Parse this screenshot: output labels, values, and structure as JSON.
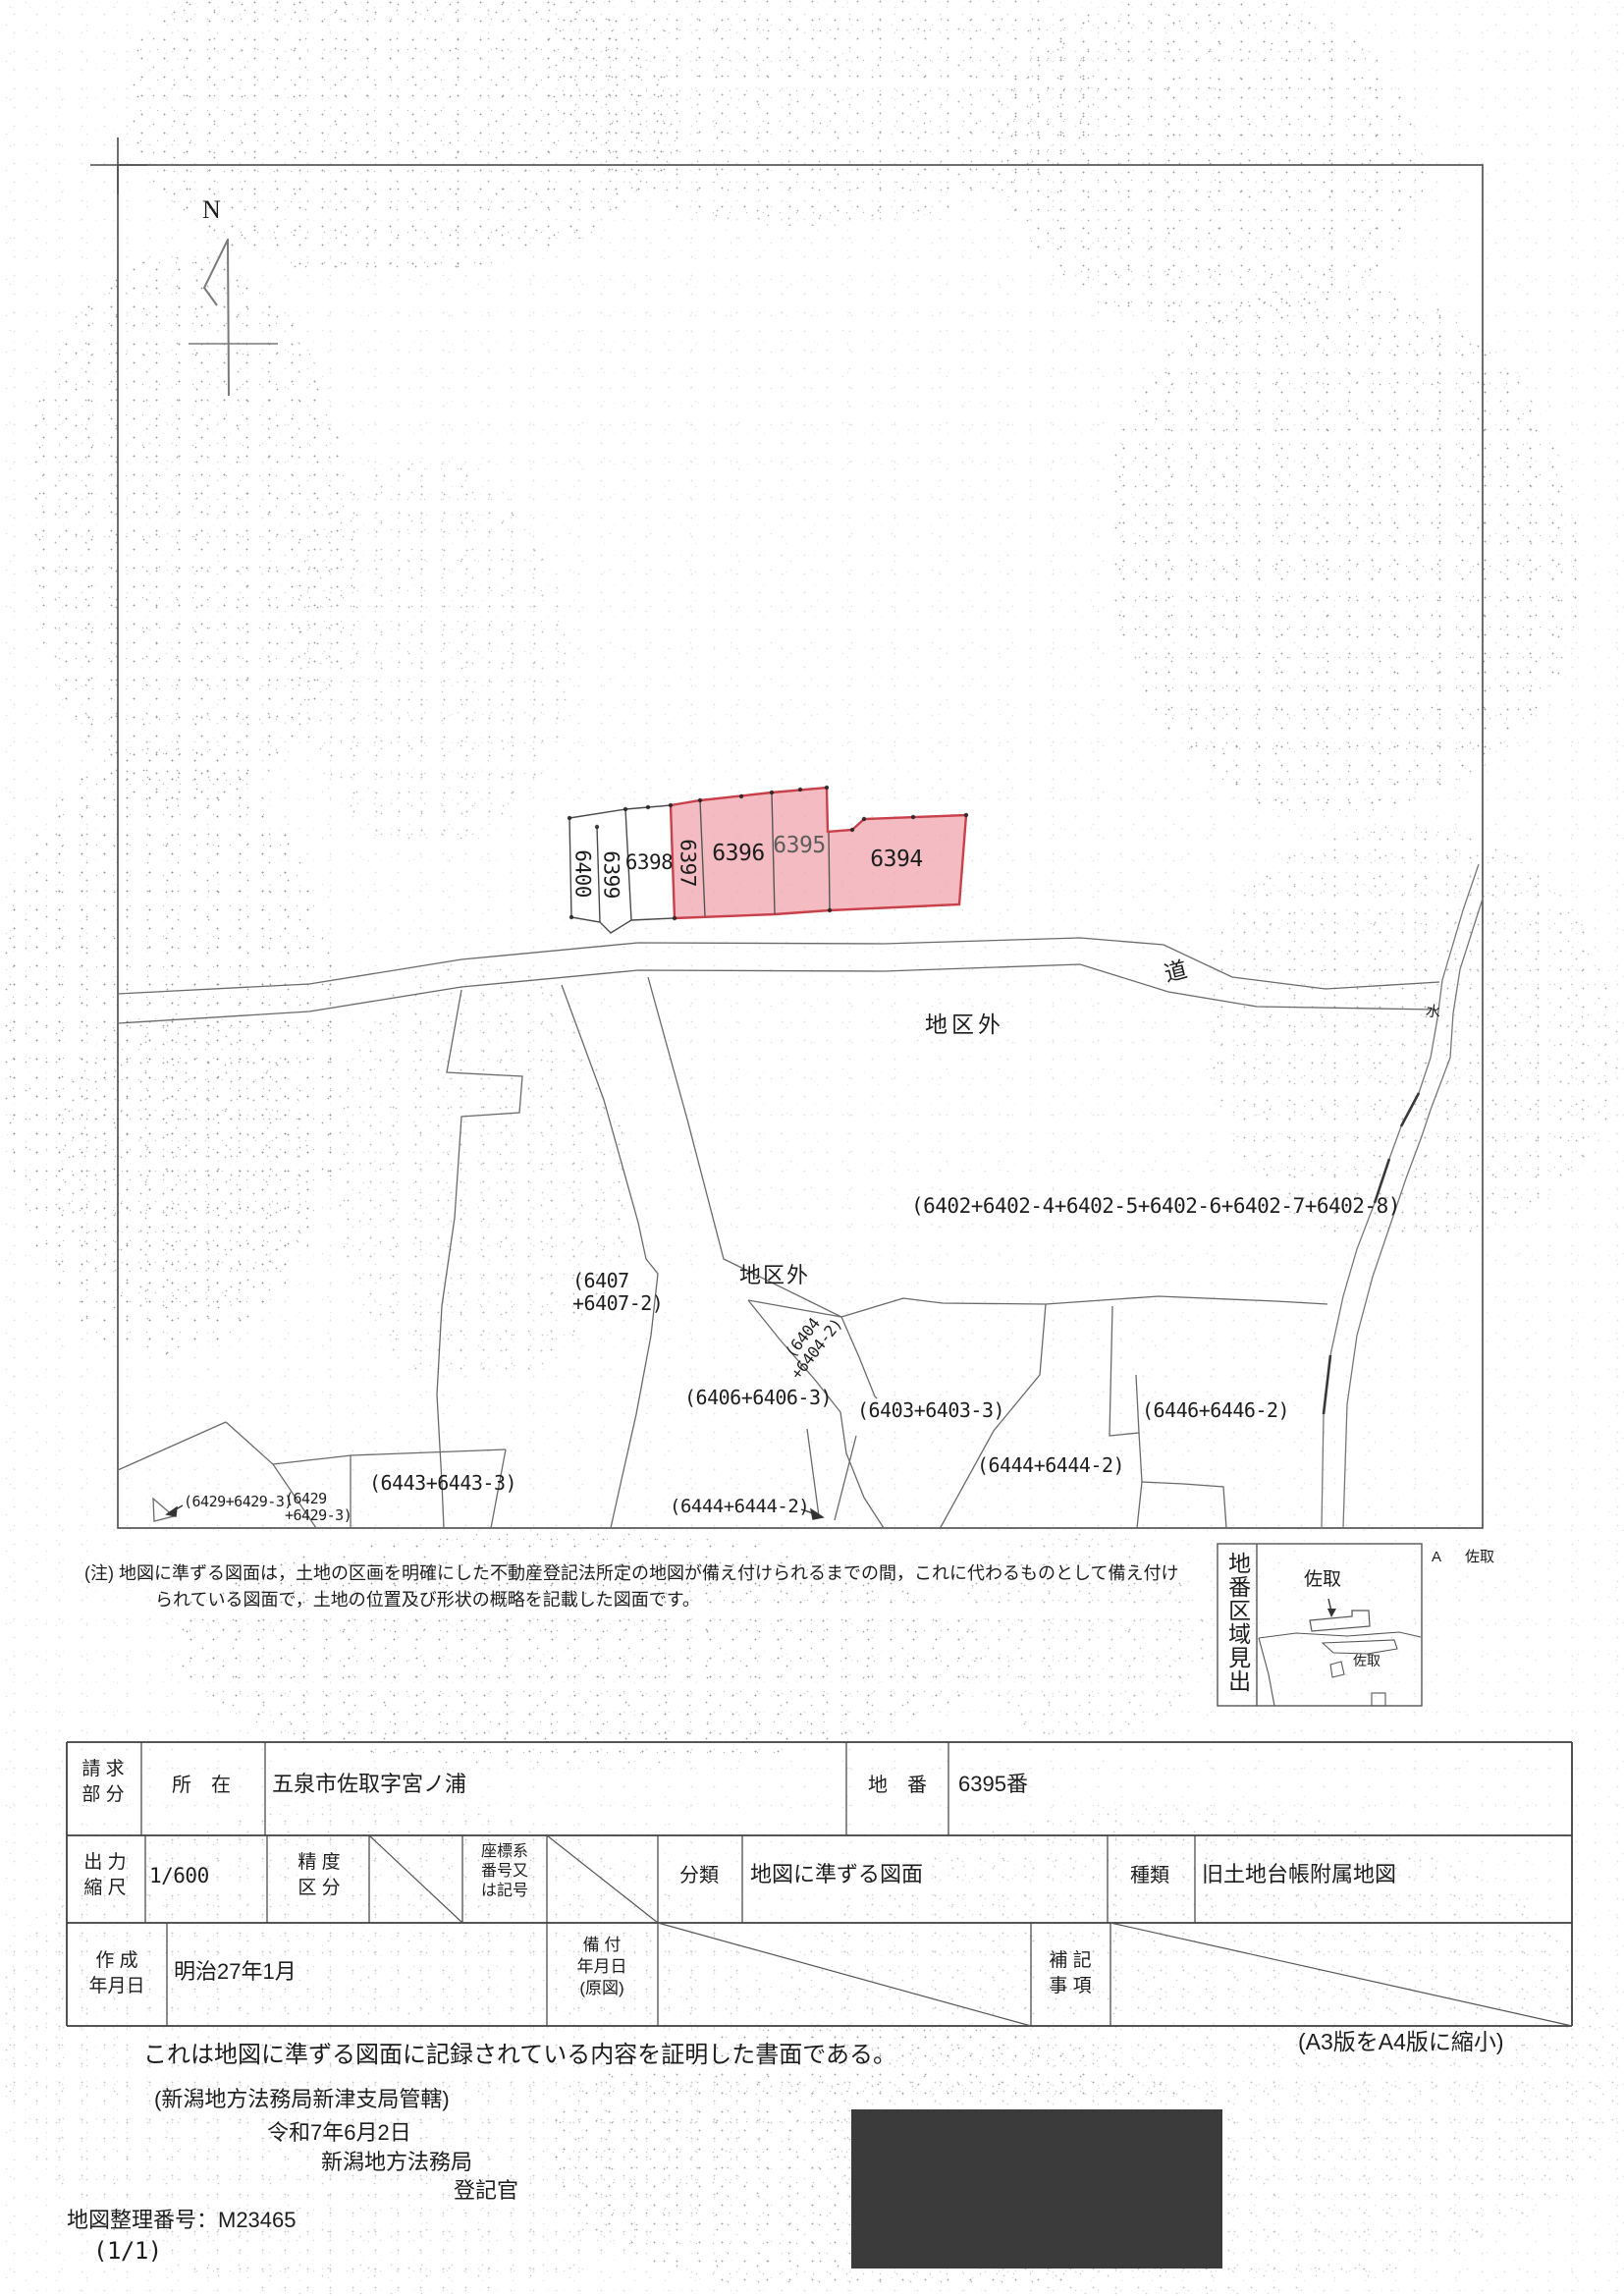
{
  "compass": {
    "label": "N"
  },
  "map": {
    "road_label": "道",
    "water_label": "水",
    "outside1": "地区外",
    "outside2": "地区外",
    "highlight_fill": "#f0a2aa",
    "highlight_stroke": "#c9404a",
    "parcels": {
      "p6400": "6400",
      "p6399": "6399",
      "p6398": "6398",
      "p6397": "6397",
      "p6396": "6396",
      "p6395": "6395",
      "p6394": "6394",
      "p6402": "(6402+6402-4+6402-5+6402-6+6402-7+6402-8)",
      "p6407": "(6407\n+6407-2)",
      "p6404": "(6404\n+6404-2)",
      "p6406": "(6406+6406-3)",
      "p6403": "(6403+6403-3)",
      "p6446": "(6446+6446-2)",
      "p6444_mid": "(6444+6444-2)",
      "p6444_bottom": "(6444+6444-2)",
      "p6443": "(6443+6443-3)",
      "p6429_a": "(6429+6429-3)",
      "p6429_b": "(6429\n+6429-3)"
    }
  },
  "index_box": {
    "title": "地番区域見出",
    "place_upper": "佐取",
    "place_lower": "佐取",
    "corner_a": "A",
    "corner_place": "佐取"
  },
  "note": {
    "line1": "(注) 地図に準ずる図面は，土地の区画を明確にした不動産登記法所定の地図が備え付けられるまでの間，これに代わるものとして備え付け",
    "line2": "られている図面で，土地の位置及び形状の概略を記載した図面です。"
  },
  "table": {
    "request_label": "請 求\n部 分",
    "location_label": "所　在",
    "location_value": "五泉市佐取字宮ノ浦",
    "parcel_label": "地　番",
    "parcel_value": "6395番",
    "scale_label": "出 力\n縮 尺",
    "scale_value": "1/600",
    "precision_label": "精 度\n区 分",
    "coord_label": "座標系\n番号又\nは記号",
    "class_label": "分類",
    "class_value": "地図に準ずる図面",
    "kind_label": "種類",
    "kind_value": "旧土地台帳附属地図",
    "created_label": "作 成\n年月日",
    "created_value": "明治27年1月",
    "filed_label": "備 付\n年月日\n(原図)",
    "remarks_label": "補 記\n事 項"
  },
  "footer": {
    "reduction_note": "(A3版をA4版に縮小)",
    "certification": "これは地図に準ずる図面に記録されている内容を証明した書面である。",
    "jurisdiction": "(新潟地方法務局新津支局管轄)",
    "date": "令和7年6月2日",
    "bureau": "新潟地方法務局",
    "registrar": "登記官",
    "map_number": "地図整理番号：M23465",
    "page_number": "(1/1)"
  }
}
